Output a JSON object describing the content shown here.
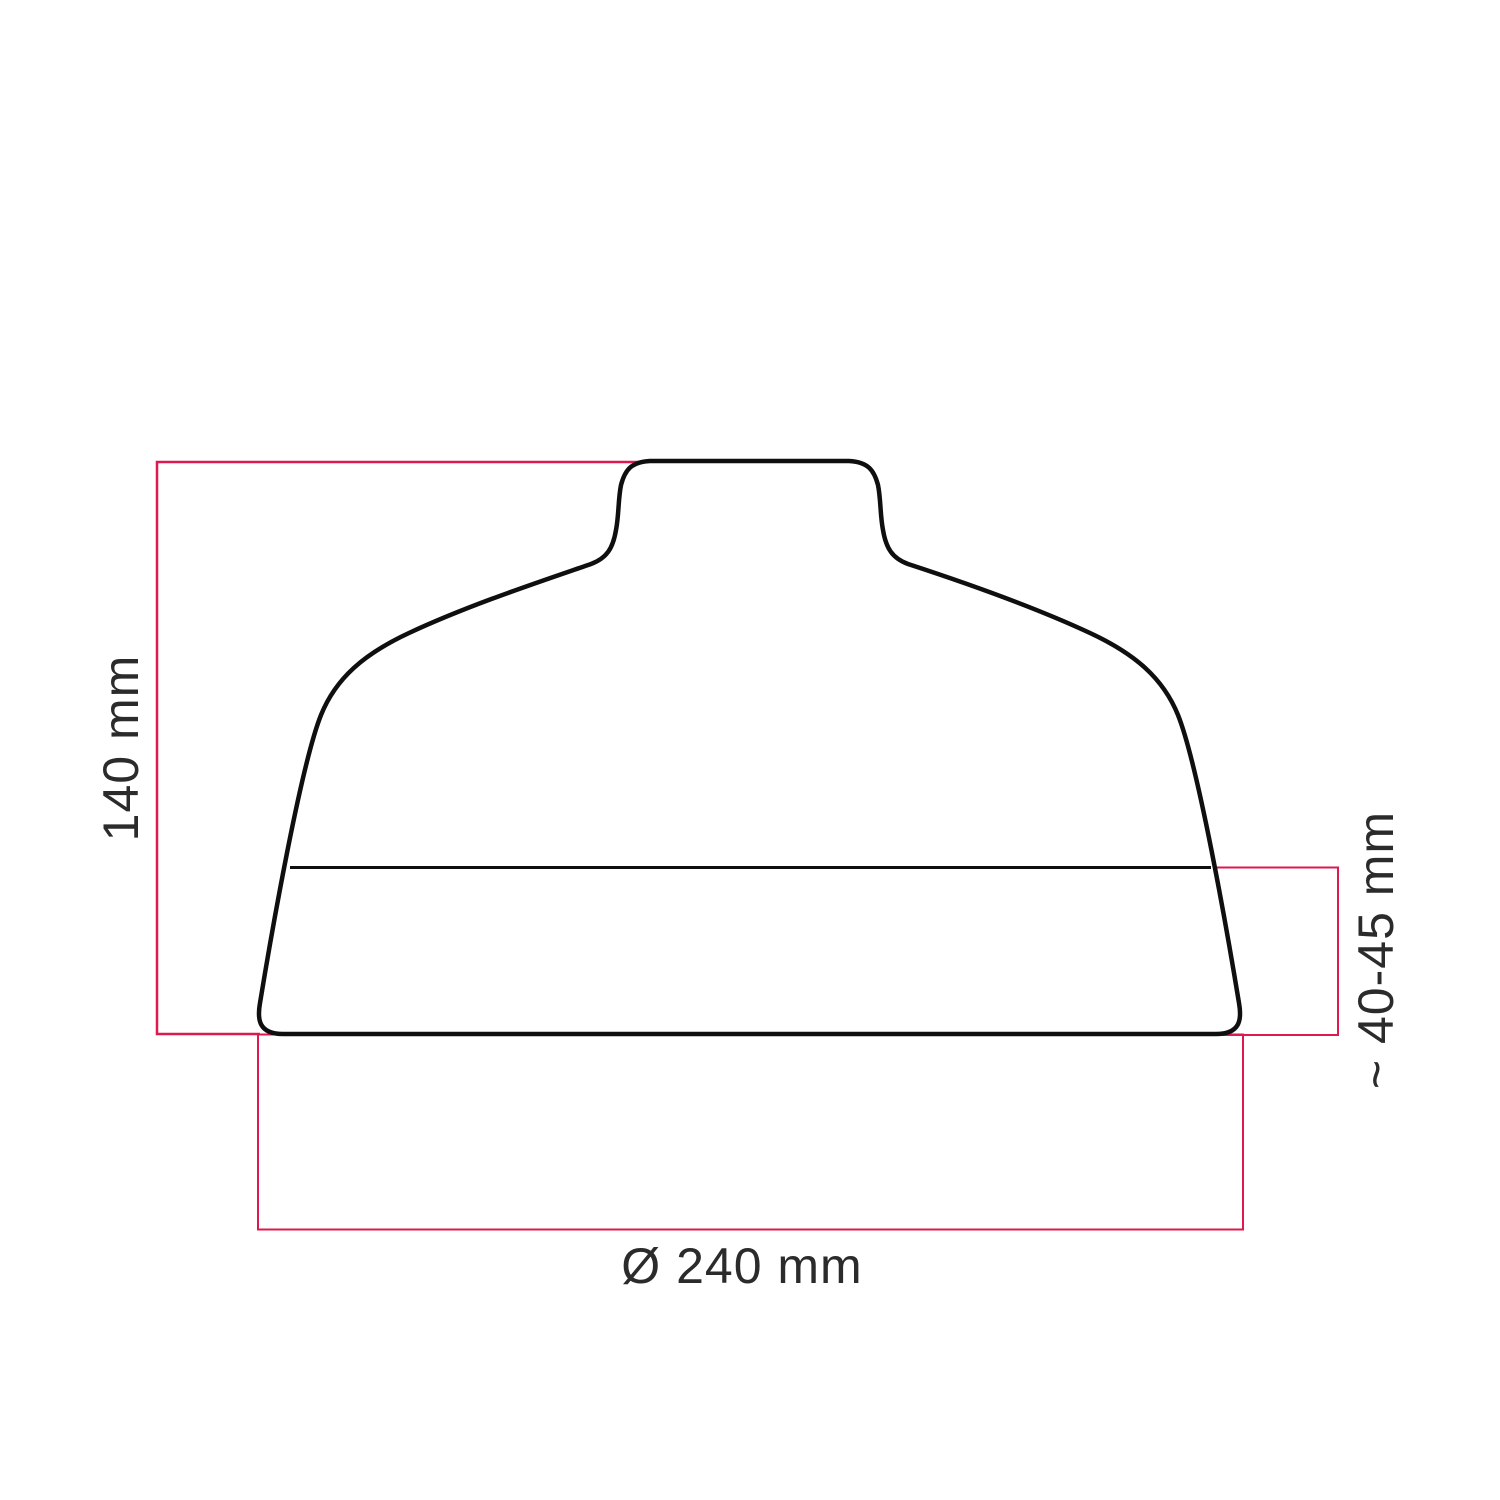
{
  "diagram": {
    "labels": {
      "height": "140 mm",
      "rim_height": "~ 40-45 mm",
      "diameter": "Ø 240 mm"
    },
    "colors": {
      "dimension_line": "#dd1950",
      "outline": "#0f0f0f",
      "text": "#2b2b2b",
      "background": "#ffffff"
    }
  }
}
